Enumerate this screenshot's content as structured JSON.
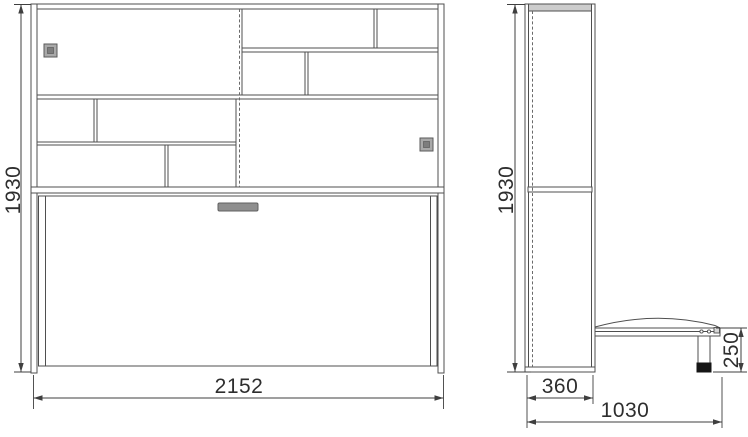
{
  "drawing": {
    "description": "wall-bed cabinet technical drawing, front and side orthographic views",
    "front_view": {
      "height": "1930",
      "width": "2152"
    },
    "side_view": {
      "height": "1930",
      "depth": "360",
      "bed_depth": "1030",
      "bed_height": "250"
    },
    "colors": {
      "line": "#4f4f4f",
      "dashed_line": "#6a6a6a",
      "door_handle_fill": "#a9a9a9",
      "door_handle_inner": "#7d7d7d",
      "bed_handle_fill": "#8f8f8f",
      "leg_foot": "#151515",
      "background": "#ffffff"
    }
  }
}
